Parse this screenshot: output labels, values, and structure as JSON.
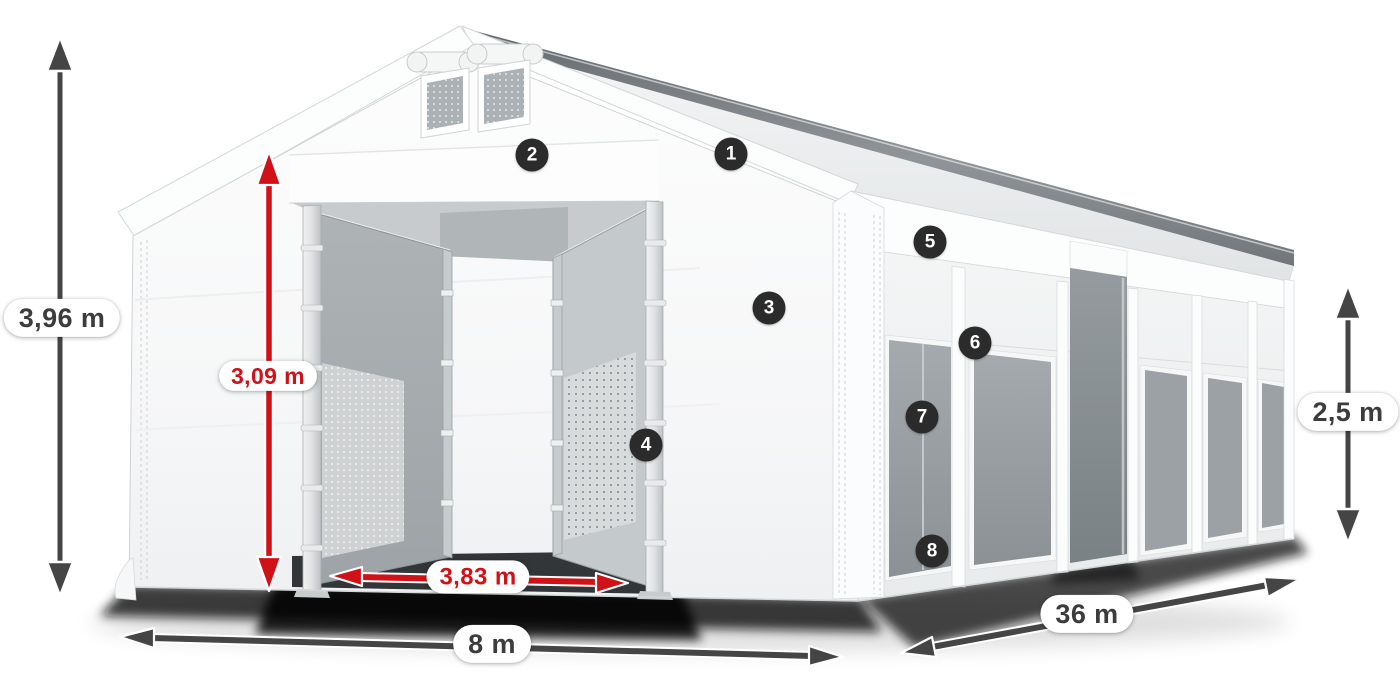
{
  "colors": {
    "arrow_dark": "#454545",
    "arrow_red": "#d01218",
    "label_text_dark": "#3c3c3c",
    "label_text_red": "#d01218",
    "label_background": "#ffffff",
    "badge_background": "#2b2b2b",
    "badge_text": "#ffffff",
    "tent_white": "#f7f8f8",
    "tent_outline": "#cfd3d4",
    "window_gray": "#9ba1a4"
  },
  "dimensions": [
    {
      "id": "total-height",
      "label": "3,96 m",
      "style": "dark"
    },
    {
      "id": "entrance-height",
      "label": "3,09 m",
      "style": "red"
    },
    {
      "id": "entrance-width",
      "label": "3,83 m",
      "style": "red"
    },
    {
      "id": "width",
      "label": "8 m",
      "style": "dark"
    },
    {
      "id": "length",
      "label": "36 m",
      "style": "dark"
    },
    {
      "id": "side-height",
      "label": "2,5 m",
      "style": "dark"
    }
  ],
  "badges": [
    {
      "number": "1"
    },
    {
      "number": "2"
    },
    {
      "number": "3"
    },
    {
      "number": "4"
    },
    {
      "number": "5"
    },
    {
      "number": "6"
    },
    {
      "number": "7"
    },
    {
      "number": "8"
    }
  ]
}
